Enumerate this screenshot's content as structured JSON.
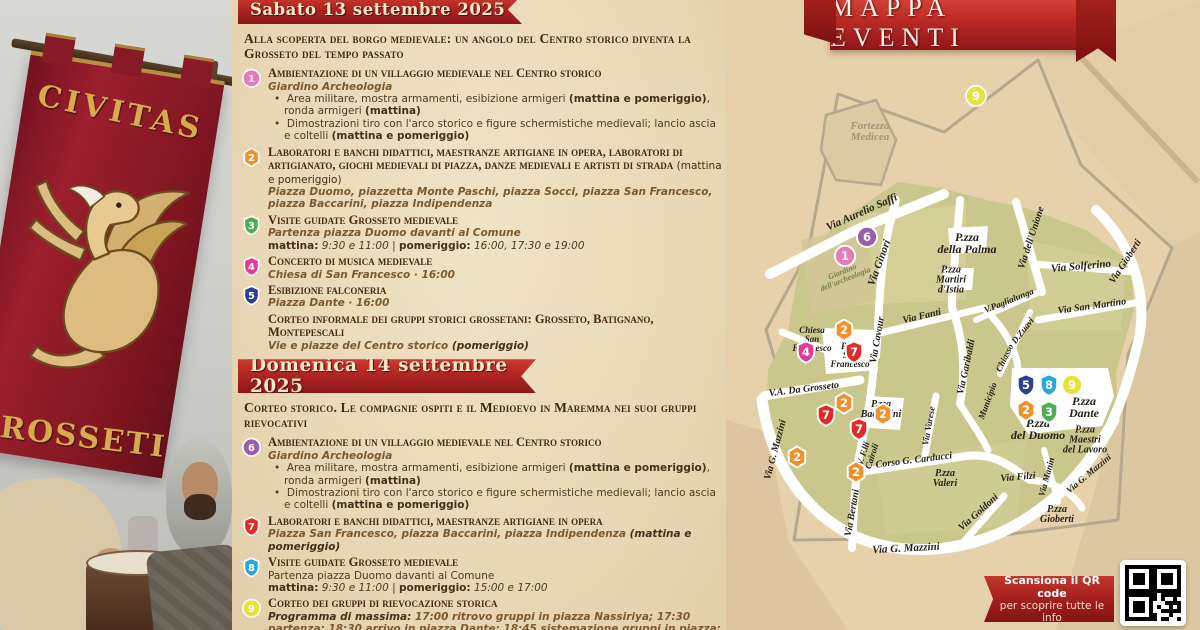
{
  "photo": {
    "banner_top_text": "CIVITAS",
    "banner_bottom_text": "GROSSETI"
  },
  "program": {
    "saturday": {
      "ribbon": "Sabato 13 settembre 2025",
      "intro": "Alla scoperta del borgo medievale: un angolo del Centro storico diventa la Grosseto del tempo passato",
      "items": [
        {
          "n": "1",
          "title": "Ambientazione di un villaggio medievale nel Centro storico",
          "lines": [
            {
              "style": "loc",
              "text": "Giardino Archeologia"
            },
            {
              "style": "bullet",
              "text": "Area militare, mostra armamenti, esibizione armigeri **(mattina e pomeriggio)**, ronda armigeri **(mattina)**"
            },
            {
              "style": "bullet",
              "text": "Dimostrazioni tiro con l'arco storico e figure schermistiche medievali; lancio ascia e coltelli **(mattina e pomeriggio)**"
            }
          ]
        },
        {
          "n": "2",
          "title": "Laboratori e banchi didattici, maestranze artigiane in opera, laboratori di artigianato, giochi medievali di piazza, danze medievali e artisti di strada",
          "title_suffix": " (mattina e pomeriggio)",
          "lines": [
            {
              "style": "loc",
              "text": "Piazza Duomo, piazzetta Monte Paschi, piazza Socci, piazza San Francesco, piazza Baccarini, piazza Indipendenza"
            }
          ]
        },
        {
          "n": "3",
          "title": "Visite guidate Grosseto medievale",
          "lines": [
            {
              "style": "loc",
              "text": "Partenza piazza Duomo davanti al Comune"
            },
            {
              "style": "time",
              "text": "**mattina:** *9:30 e 11:00* | **pomeriggio:** *16:00, 17:30 e 19:00*"
            }
          ]
        },
        {
          "n": "4",
          "title": "Concerto di musica medievale",
          "lines": [
            {
              "style": "loc",
              "text": "Chiesa di San Francesco · 16:00"
            }
          ]
        },
        {
          "n": "5",
          "title": "Esibizione falconeria",
          "lines": [
            {
              "style": "loc",
              "text": "Piazza Dante · 16:00"
            }
          ]
        },
        {
          "n": "",
          "title": "Corteo informale dei gruppi storici grossetani: Grosseto, Batignano, Montepescali",
          "lines": [
            {
              "style": "loc",
              "text": "Vie e piazze del Centro storico **(pomeriggio)**"
            }
          ]
        }
      ]
    },
    "sunday": {
      "ribbon": "Domenica 14 settembre 2025",
      "intro": "Corteo storico. Le compagnie ospiti e il Medioevo in Maremma nei suoi gruppi rievocativi",
      "items": [
        {
          "n": "6",
          "title": "Ambientazione di un villaggio medievale nel Centro storico",
          "lines": [
            {
              "style": "loc",
              "text": "Giardino Archeologia"
            },
            {
              "style": "bullet",
              "text": "Area militare, mostra armamenti, esibizione armigeri **(mattina e pomeriggio)**, ronda armigeri **(mattina)**"
            },
            {
              "style": "bullet",
              "text": "Dimostrazioni tiro con l'arco storico e figure schermistiche medievali; lancio ascia e coltelli **(mattina e pomeriggio)**"
            }
          ]
        },
        {
          "n": "7",
          "title": "Laboratori e banchi didattici, maestranze artigiane in opera",
          "lines": [
            {
              "style": "loc",
              "text": "Piazza San Francesco, piazza Baccarini, piazza Indipendenza **(mattina e pomeriggio)**"
            }
          ]
        },
        {
          "n": "8",
          "title": "Visite guidate Grosseto medievale",
          "lines": [
            {
              "style": "plain",
              "text": "Partenza piazza Duomo davanti al Comune"
            },
            {
              "style": "time",
              "text": "**mattina:** *9:30 e 11:00* | **pomeriggio:** *15:00 e 17:00*"
            }
          ]
        },
        {
          "n": "9",
          "title": "Corteo dei gruppi di rievocazione storica",
          "lines": [
            {
              "style": "loc",
              "text": "**Programma di massima:**  17:00 ritrovo gruppi in piazza Nassiriya; 17:30 partenza; 18:30 arrivo in piazza Dante; 18:45 sistemazione gruppi in piazza; 19:00 inizio esibizioni; 20:00 uscita dei gruppi; 20:15 termine manifestazione."
            }
          ]
        }
      ]
    }
  },
  "map": {
    "title": "MAPPA EVENTI",
    "qr_ribbon": {
      "line1": "Scansiona il QR code",
      "line2": "per scoprire tutte le info"
    },
    "marker_styles": {
      "1": {
        "color": "#e87bb6",
        "shape": "circle"
      },
      "2": {
        "color": "#f2912c",
        "shape": "hex"
      },
      "3": {
        "color": "#4fae4f",
        "shape": "shield"
      },
      "4": {
        "color": "#e23a94",
        "shape": "shield"
      },
      "5": {
        "color": "#2e3f90",
        "shape": "shield"
      },
      "6": {
        "color": "#9c5fa5",
        "shape": "circle"
      },
      "7": {
        "color": "#e22828",
        "shape": "shield"
      },
      "8": {
        "color": "#25a8e0",
        "shape": "shield"
      },
      "9": {
        "color": "#e8e23c",
        "shape": "circle"
      }
    },
    "streets": [
      {
        "label": "Via Aurelio Saffi",
        "x": 136,
        "y": 213,
        "r": -24,
        "s": 11
      },
      {
        "label": "Via Ginori",
        "x": 154,
        "y": 263,
        "r": -70,
        "s": 11
      },
      {
        "label": "Via Cavour",
        "x": 152,
        "y": 340,
        "r": -80,
        "s": 10
      },
      {
        "label": "Via Fanti",
        "x": 196,
        "y": 317,
        "r": -13,
        "s": 10
      },
      {
        "label": "Via dell'Unione",
        "x": 306,
        "y": 238,
        "r": -72,
        "s": 10
      },
      {
        "label": "Via Solferino",
        "x": 355,
        "y": 267,
        "r": -5,
        "s": 11
      },
      {
        "label": "Via San Martino",
        "x": 366,
        "y": 307,
        "r": -8,
        "s": 10
      },
      {
        "label": "Via Gioberti",
        "x": 400,
        "y": 262,
        "r": -57,
        "s": 10
      },
      {
        "label": "V.Paglialunga",
        "x": 283,
        "y": 301,
        "r": -22,
        "s": 9
      },
      {
        "label": "Chiasso",
        "x": 279,
        "y": 358,
        "r": -64,
        "s": 9
      },
      {
        "label": "D.Zuavi",
        "x": 297,
        "y": 331,
        "r": -52,
        "s": 9
      },
      {
        "label": "Via Garibaldi",
        "x": 241,
        "y": 367,
        "r": -78,
        "s": 10
      },
      {
        "label": "Municipio",
        "x": 262,
        "y": 401,
        "r": -70,
        "s": 9
      },
      {
        "label": "V.A. Da Grosseto",
        "x": 78,
        "y": 390,
        "r": -7,
        "s": 10
      },
      {
        "label": "Via G. Mazzini",
        "x": 50,
        "y": 450,
        "r": -75,
        "s": 10
      },
      {
        "label": "Via Varese",
        "x": 203,
        "y": 426,
        "r": -80,
        "s": 9
      },
      {
        "label": "V. F.lli\nCairoli",
        "x": 142,
        "y": 455,
        "r": -72,
        "s": 9
      },
      {
        "label": "Corso G. Carducci",
        "x": 188,
        "y": 461,
        "r": -7,
        "s": 10
      },
      {
        "label": "Via Goldoni",
        "x": 253,
        "y": 513,
        "r": -42,
        "s": 10
      },
      {
        "label": "Via Bertani",
        "x": 127,
        "y": 513,
        "r": -80,
        "s": 10
      },
      {
        "label": "Via G. Mazzini",
        "x": 180,
        "y": 549,
        "r": -3,
        "s": 11
      },
      {
        "label": "Via Filzi",
        "x": 292,
        "y": 478,
        "r": -5,
        "s": 10
      },
      {
        "label": "Via Manin",
        "x": 321,
        "y": 477,
        "r": -75,
        "s": 9
      },
      {
        "label": "Via G. Mazzini",
        "x": 363,
        "y": 474,
        "r": -40,
        "s": 9
      }
    ],
    "places": [
      {
        "label": "P.zza\ndella Palma",
        "x": 241,
        "y": 243,
        "s": 12
      },
      {
        "label": "P.zza\nMartiri\nd'Istia",
        "x": 225,
        "y": 281,
        "s": 10
      },
      {
        "label": "Chiesa\nSan\nFrancesco",
        "x": 86,
        "y": 340,
        "s": 9
      },
      {
        "label": "P.zza\nSan\nFrancesco",
        "x": 124,
        "y": 356,
        "s": 9
      },
      {
        "label": "P.zza\nBaccarini",
        "x": 155,
        "y": 410,
        "s": 10
      },
      {
        "label": "P.zza\nValeri",
        "x": 219,
        "y": 479,
        "s": 10
      },
      {
        "label": "P.zza\nGioberti",
        "x": 331,
        "y": 515,
        "s": 10
      },
      {
        "label": "P.zza\nMaestri\ndel Lavoro",
        "x": 359,
        "y": 441,
        "s": 10
      },
      {
        "label": "P.zza\ndel Duomo",
        "x": 312,
        "y": 429,
        "s": 12
      },
      {
        "label": "P.zza\nDante",
        "x": 358,
        "y": 407,
        "s": 12
      },
      {
        "label": "Fortezza\nMedicea",
        "x": 144,
        "y": 132,
        "s": 11,
        "cls": "fort"
      },
      {
        "label": "Giardino\ndell'archeologia",
        "x": 118,
        "y": 276,
        "s": 8,
        "cls": "garden",
        "r": -22
      }
    ],
    "markers": [
      {
        "n": "9",
        "x": 250,
        "y": 96
      },
      {
        "n": "6",
        "x": 141,
        "y": 237
      },
      {
        "n": "1",
        "x": 119,
        "y": 256
      },
      {
        "n": "2",
        "x": 118,
        "y": 330
      },
      {
        "n": "4",
        "x": 80,
        "y": 352
      },
      {
        "n": "7",
        "x": 128,
        "y": 352
      },
      {
        "n": "2",
        "x": 118,
        "y": 403
      },
      {
        "n": "7",
        "x": 100,
        "y": 415
      },
      {
        "n": "2",
        "x": 157,
        "y": 414
      },
      {
        "n": "7",
        "x": 133,
        "y": 429
      },
      {
        "n": "2",
        "x": 71,
        "y": 457
      },
      {
        "n": "2",
        "x": 130,
        "y": 472
      },
      {
        "n": "5",
        "x": 300,
        "y": 385
      },
      {
        "n": "8",
        "x": 323,
        "y": 385
      },
      {
        "n": "9",
        "x": 346,
        "y": 385
      },
      {
        "n": "2",
        "x": 300,
        "y": 410
      },
      {
        "n": "3",
        "x": 323,
        "y": 412
      }
    ]
  }
}
